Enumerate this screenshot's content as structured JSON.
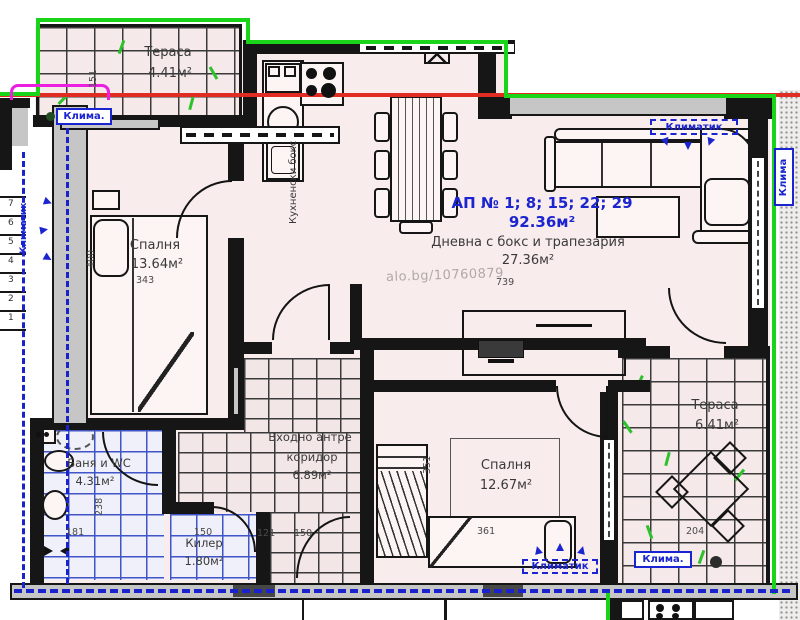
{
  "plan": {
    "watermark": "alo.bg/10760879",
    "title": {
      "line1": "АП № 1; 8; 15; 22; 29",
      "line2": "92.36м²"
    },
    "rooms": {
      "living": {
        "name": "Дневна с бокс и трапезария",
        "area": "27.36м²"
      },
      "bedroom1": {
        "name": "Спалня",
        "area": "13.64м²"
      },
      "bedroom2": {
        "name": "Спалня",
        "area": "12.67м²"
      },
      "bath": {
        "name": "Баня и WC",
        "area": "4.31м²"
      },
      "corridor": {
        "name1": "Входно антре",
        "name2": "коридор",
        "area": "6.89м²"
      },
      "storage": {
        "name": "Килер",
        "area": "1.80м²"
      },
      "terrace_top": {
        "name": "Тераса",
        "area": "4.41м²"
      },
      "terrace_right": {
        "name": "Тераса",
        "area": "6.41м²"
      },
      "kitchen_box": "Кухненски бокс"
    },
    "climate": {
      "short": "Клима.",
      "long": "Климатик",
      "right": "Клима"
    },
    "dims": {
      "w151": "151",
      "h400": "400",
      "w343": "343",
      "w739": "739",
      "h238": "238",
      "w181": "181",
      "h351": "351",
      "w361": "361",
      "w121": "121",
      "w150": "150",
      "w150b": "150",
      "w204": "204"
    },
    "stairs": [
      "7",
      "6",
      "5",
      "4",
      "3",
      "2",
      "1"
    ],
    "colors": {
      "wall": "#161616",
      "room_fill": "#f8ecec",
      "annotation_green": "#19d419",
      "annotation_red": "#e02c22",
      "annotation_blue": "#1a24d0",
      "annotation_magenta": "#ea1fe0",
      "tile_blue": "#4055c8"
    }
  }
}
